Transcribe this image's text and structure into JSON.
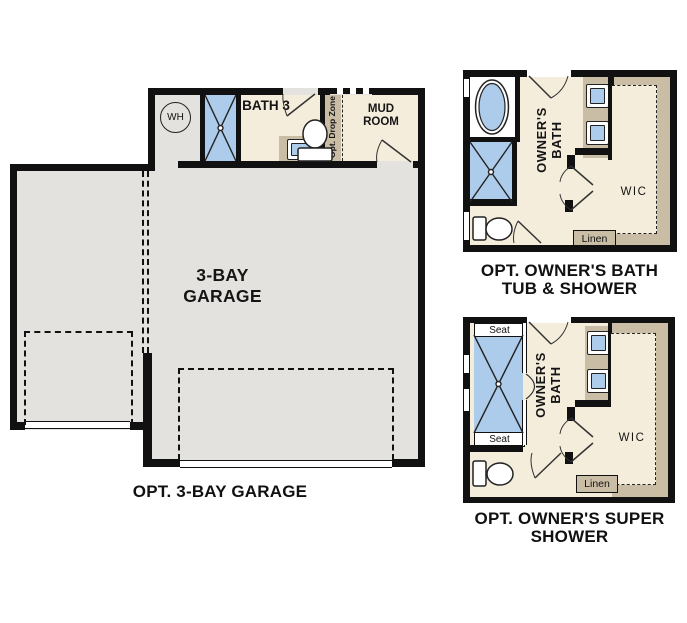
{
  "colors": {
    "background": "#ffffff",
    "wall": "#111111",
    "garage_floor": "#e3e2de",
    "room_floor": "#f4eddb",
    "cabinet_tan": "#c9bda5",
    "fixture_blue": "#adcbea"
  },
  "garage_plan": {
    "caption": "OPT. 3-BAY GARAGE",
    "room_label_line1": "3-BAY",
    "room_label_line2": "GARAGE",
    "water_heater_label": "WH",
    "bath_label": "BATH 3",
    "mud_room_line1": "MUD",
    "mud_room_line2": "ROOM",
    "drop_zone_label": "Opt. Drop Zone"
  },
  "owners_bath_plan": {
    "caption_line1": "OPT. OWNER'S BATH",
    "caption_line2": "TUB & SHOWER",
    "room_label_line1": "OWNER'S",
    "room_label_line2": "BATH",
    "wic_label": "WIC",
    "linen_label": "Linen"
  },
  "super_shower_plan": {
    "caption_line1": "OPT. OWNER'S SUPER",
    "caption_line2": "SHOWER",
    "room_label_line1": "OWNER'S",
    "room_label_line2": "BATH",
    "wic_label": "WIC",
    "linen_label": "Linen",
    "seat_top_label": "Seat",
    "seat_bottom_label": "Seat"
  }
}
